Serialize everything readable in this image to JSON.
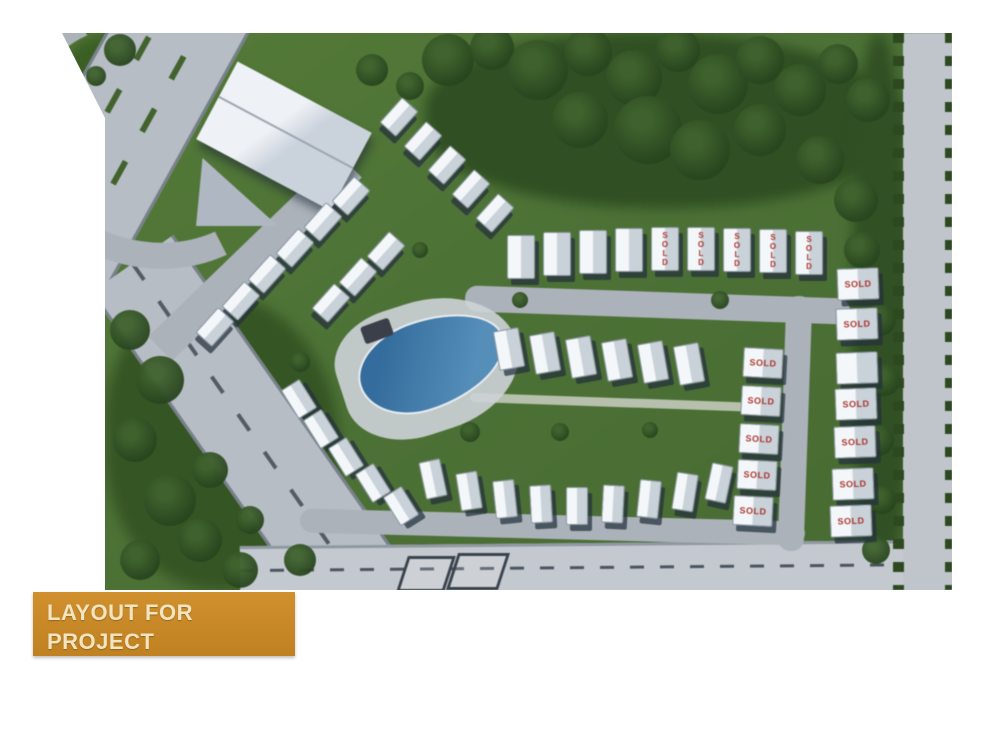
{
  "banner": {
    "line1": "LAYOUT FOR",
    "line2": "PROJECT"
  },
  "labels": {
    "sold": "SOLD"
  },
  "palette": {
    "banner_bg": "#c8872b",
    "banner_text": "#f2e4c0",
    "sold_red": "#b5342c",
    "grass": "#4a7430",
    "tree": "#26471b",
    "road": "#b6bdc6",
    "roof_white": "#f4f7fa",
    "pool_blue": "#3a7cb0",
    "page_bg": "#ffffff"
  },
  "site": {
    "clusters": [
      {
        "id": "top-diagonal-row",
        "rot": 42,
        "w": 20,
        "h": 32,
        "houses": [
          {
            "x": 398,
            "y": 116
          },
          {
            "x": 422,
            "y": 140
          },
          {
            "x": 446,
            "y": 164
          },
          {
            "x": 470,
            "y": 188
          },
          {
            "x": 494,
            "y": 212
          }
        ]
      },
      {
        "id": "left-chevron-upper",
        "rot": 42,
        "w": 20,
        "h": 32,
        "houses": [
          {
            "x": 350,
            "y": 195
          },
          {
            "x": 322,
            "y": 221
          },
          {
            "x": 294,
            "y": 247
          },
          {
            "x": 266,
            "y": 273
          },
          {
            "x": 240,
            "y": 300
          },
          {
            "x": 214,
            "y": 326
          }
        ]
      },
      {
        "id": "left-chevron-lower",
        "rot": 42,
        "w": 20,
        "h": 32,
        "houses": [
          {
            "x": 385,
            "y": 250
          },
          {
            "x": 357,
            "y": 276
          },
          {
            "x": 330,
            "y": 302
          }
        ]
      },
      {
        "id": "southwest-arc",
        "rot": -32,
        "w": 20,
        "h": 32,
        "houses": [
          {
            "x": 298,
            "y": 398
          },
          {
            "x": 320,
            "y": 428
          },
          {
            "x": 345,
            "y": 456
          },
          {
            "x": 372,
            "y": 482
          },
          {
            "x": 400,
            "y": 505
          }
        ]
      },
      {
        "id": "south-row",
        "rot": 0,
        "w": 20,
        "h": 36,
        "houses": [
          {
            "x": 432,
            "y": 478,
            "rot": -12
          },
          {
            "x": 468,
            "y": 490,
            "rot": -9
          },
          {
            "x": 504,
            "y": 498,
            "rot": -6
          },
          {
            "x": 540,
            "y": 503,
            "rot": -3
          },
          {
            "x": 576,
            "y": 505,
            "rot": 0
          },
          {
            "x": 612,
            "y": 503,
            "rot": 3
          },
          {
            "x": 648,
            "y": 498,
            "rot": 6
          },
          {
            "x": 684,
            "y": 491,
            "rot": 9
          },
          {
            "x": 718,
            "y": 482,
            "rot": 12
          }
        ]
      },
      {
        "id": "middle-row",
        "rot": -10,
        "w": 24,
        "h": 38,
        "houses": [
          {
            "x": 508,
            "y": 348
          },
          {
            "x": 544,
            "y": 352
          },
          {
            "x": 580,
            "y": 356
          },
          {
            "x": 616,
            "y": 359
          },
          {
            "x": 652,
            "y": 361
          },
          {
            "x": 688,
            "y": 363
          }
        ]
      },
      {
        "id": "north-row",
        "rot": 0,
        "w": 26,
        "h": 42,
        "soldVertical": true,
        "houses": [
          {
            "x": 520,
            "y": 256
          },
          {
            "x": 556,
            "y": 253
          },
          {
            "x": 592,
            "y": 251
          },
          {
            "x": 628,
            "y": 249
          },
          {
            "x": 664,
            "y": 248,
            "sold": true
          },
          {
            "x": 700,
            "y": 248,
            "sold": true
          },
          {
            "x": 736,
            "y": 249,
            "sold": true
          },
          {
            "x": 772,
            "y": 250,
            "sold": true
          },
          {
            "x": 808,
            "y": 252,
            "sold": true
          }
        ]
      },
      {
        "id": "east-inner-column",
        "rot": 3,
        "w": 38,
        "h": 28,
        "houses": [
          {
            "x": 762,
            "y": 362,
            "sold": true
          },
          {
            "x": 760,
            "y": 400,
            "sold": true
          },
          {
            "x": 758,
            "y": 438,
            "sold": true
          },
          {
            "x": 756,
            "y": 474,
            "sold": true
          },
          {
            "x": 752,
            "y": 510,
            "sold": true
          }
        ]
      },
      {
        "id": "east-outer-column",
        "rot": -2,
        "w": 40,
        "h": 30,
        "houses": [
          {
            "x": 857,
            "y": 283,
            "sold": true
          },
          {
            "x": 856,
            "y": 323,
            "sold": true
          },
          {
            "x": 856,
            "y": 367
          },
          {
            "x": 855,
            "y": 403,
            "sold": true
          },
          {
            "x": 854,
            "y": 441,
            "sold": true
          },
          {
            "x": 852,
            "y": 483,
            "sold": true
          },
          {
            "x": 850,
            "y": 520,
            "sold": true
          }
        ]
      }
    ],
    "trees": [
      {
        "x": 448,
        "y": 60,
        "r": 26
      },
      {
        "x": 492,
        "y": 48,
        "r": 22
      },
      {
        "x": 538,
        "y": 70,
        "r": 30
      },
      {
        "x": 588,
        "y": 52,
        "r": 24
      },
      {
        "x": 634,
        "y": 78,
        "r": 28
      },
      {
        "x": 678,
        "y": 50,
        "r": 22
      },
      {
        "x": 718,
        "y": 84,
        "r": 30
      },
      {
        "x": 760,
        "y": 60,
        "r": 24
      },
      {
        "x": 800,
        "y": 90,
        "r": 26
      },
      {
        "x": 838,
        "y": 64,
        "r": 20
      },
      {
        "x": 868,
        "y": 100,
        "r": 22
      },
      {
        "x": 648,
        "y": 130,
        "r": 34
      },
      {
        "x": 580,
        "y": 120,
        "r": 28
      },
      {
        "x": 700,
        "y": 150,
        "r": 30
      },
      {
        "x": 760,
        "y": 130,
        "r": 26
      },
      {
        "x": 820,
        "y": 160,
        "r": 24
      },
      {
        "x": 856,
        "y": 200,
        "r": 22
      },
      {
        "x": 862,
        "y": 250,
        "r": 18
      },
      {
        "x": 880,
        "y": 320,
        "r": 16
      },
      {
        "x": 884,
        "y": 380,
        "r": 16
      },
      {
        "x": 878,
        "y": 440,
        "r": 16
      },
      {
        "x": 882,
        "y": 500,
        "r": 14
      },
      {
        "x": 876,
        "y": 550,
        "r": 14
      },
      {
        "x": 130,
        "y": 330,
        "r": 20
      },
      {
        "x": 160,
        "y": 380,
        "r": 24
      },
      {
        "x": 135,
        "y": 440,
        "r": 22
      },
      {
        "x": 170,
        "y": 500,
        "r": 26
      },
      {
        "x": 140,
        "y": 560,
        "r": 20
      },
      {
        "x": 200,
        "y": 540,
        "r": 22
      },
      {
        "x": 240,
        "y": 570,
        "r": 18
      },
      {
        "x": 300,
        "y": 560,
        "r": 16
      },
      {
        "x": 210,
        "y": 470,
        "r": 18
      },
      {
        "x": 250,
        "y": 520,
        "r": 14
      },
      {
        "x": 120,
        "y": 50,
        "r": 16
      },
      {
        "x": 96,
        "y": 76,
        "r": 10
      },
      {
        "x": 372,
        "y": 70,
        "r": 16
      },
      {
        "x": 410,
        "y": 86,
        "r": 14
      },
      {
        "x": 335,
        "y": 300,
        "r": 10
      },
      {
        "x": 520,
        "y": 300,
        "r": 8
      },
      {
        "x": 470,
        "y": 432,
        "r": 10
      },
      {
        "x": 560,
        "y": 432,
        "r": 9
      },
      {
        "x": 650,
        "y": 430,
        "r": 8
      },
      {
        "x": 720,
        "y": 300,
        "r": 9
      },
      {
        "x": 420,
        "y": 250,
        "r": 8
      },
      {
        "x": 300,
        "y": 362,
        "r": 10
      }
    ],
    "pads": [
      {
        "x": 402,
        "y": 556,
        "w": 42,
        "h": 30
      },
      {
        "x": 452,
        "y": 553,
        "w": 46,
        "h": 31
      }
    ]
  }
}
